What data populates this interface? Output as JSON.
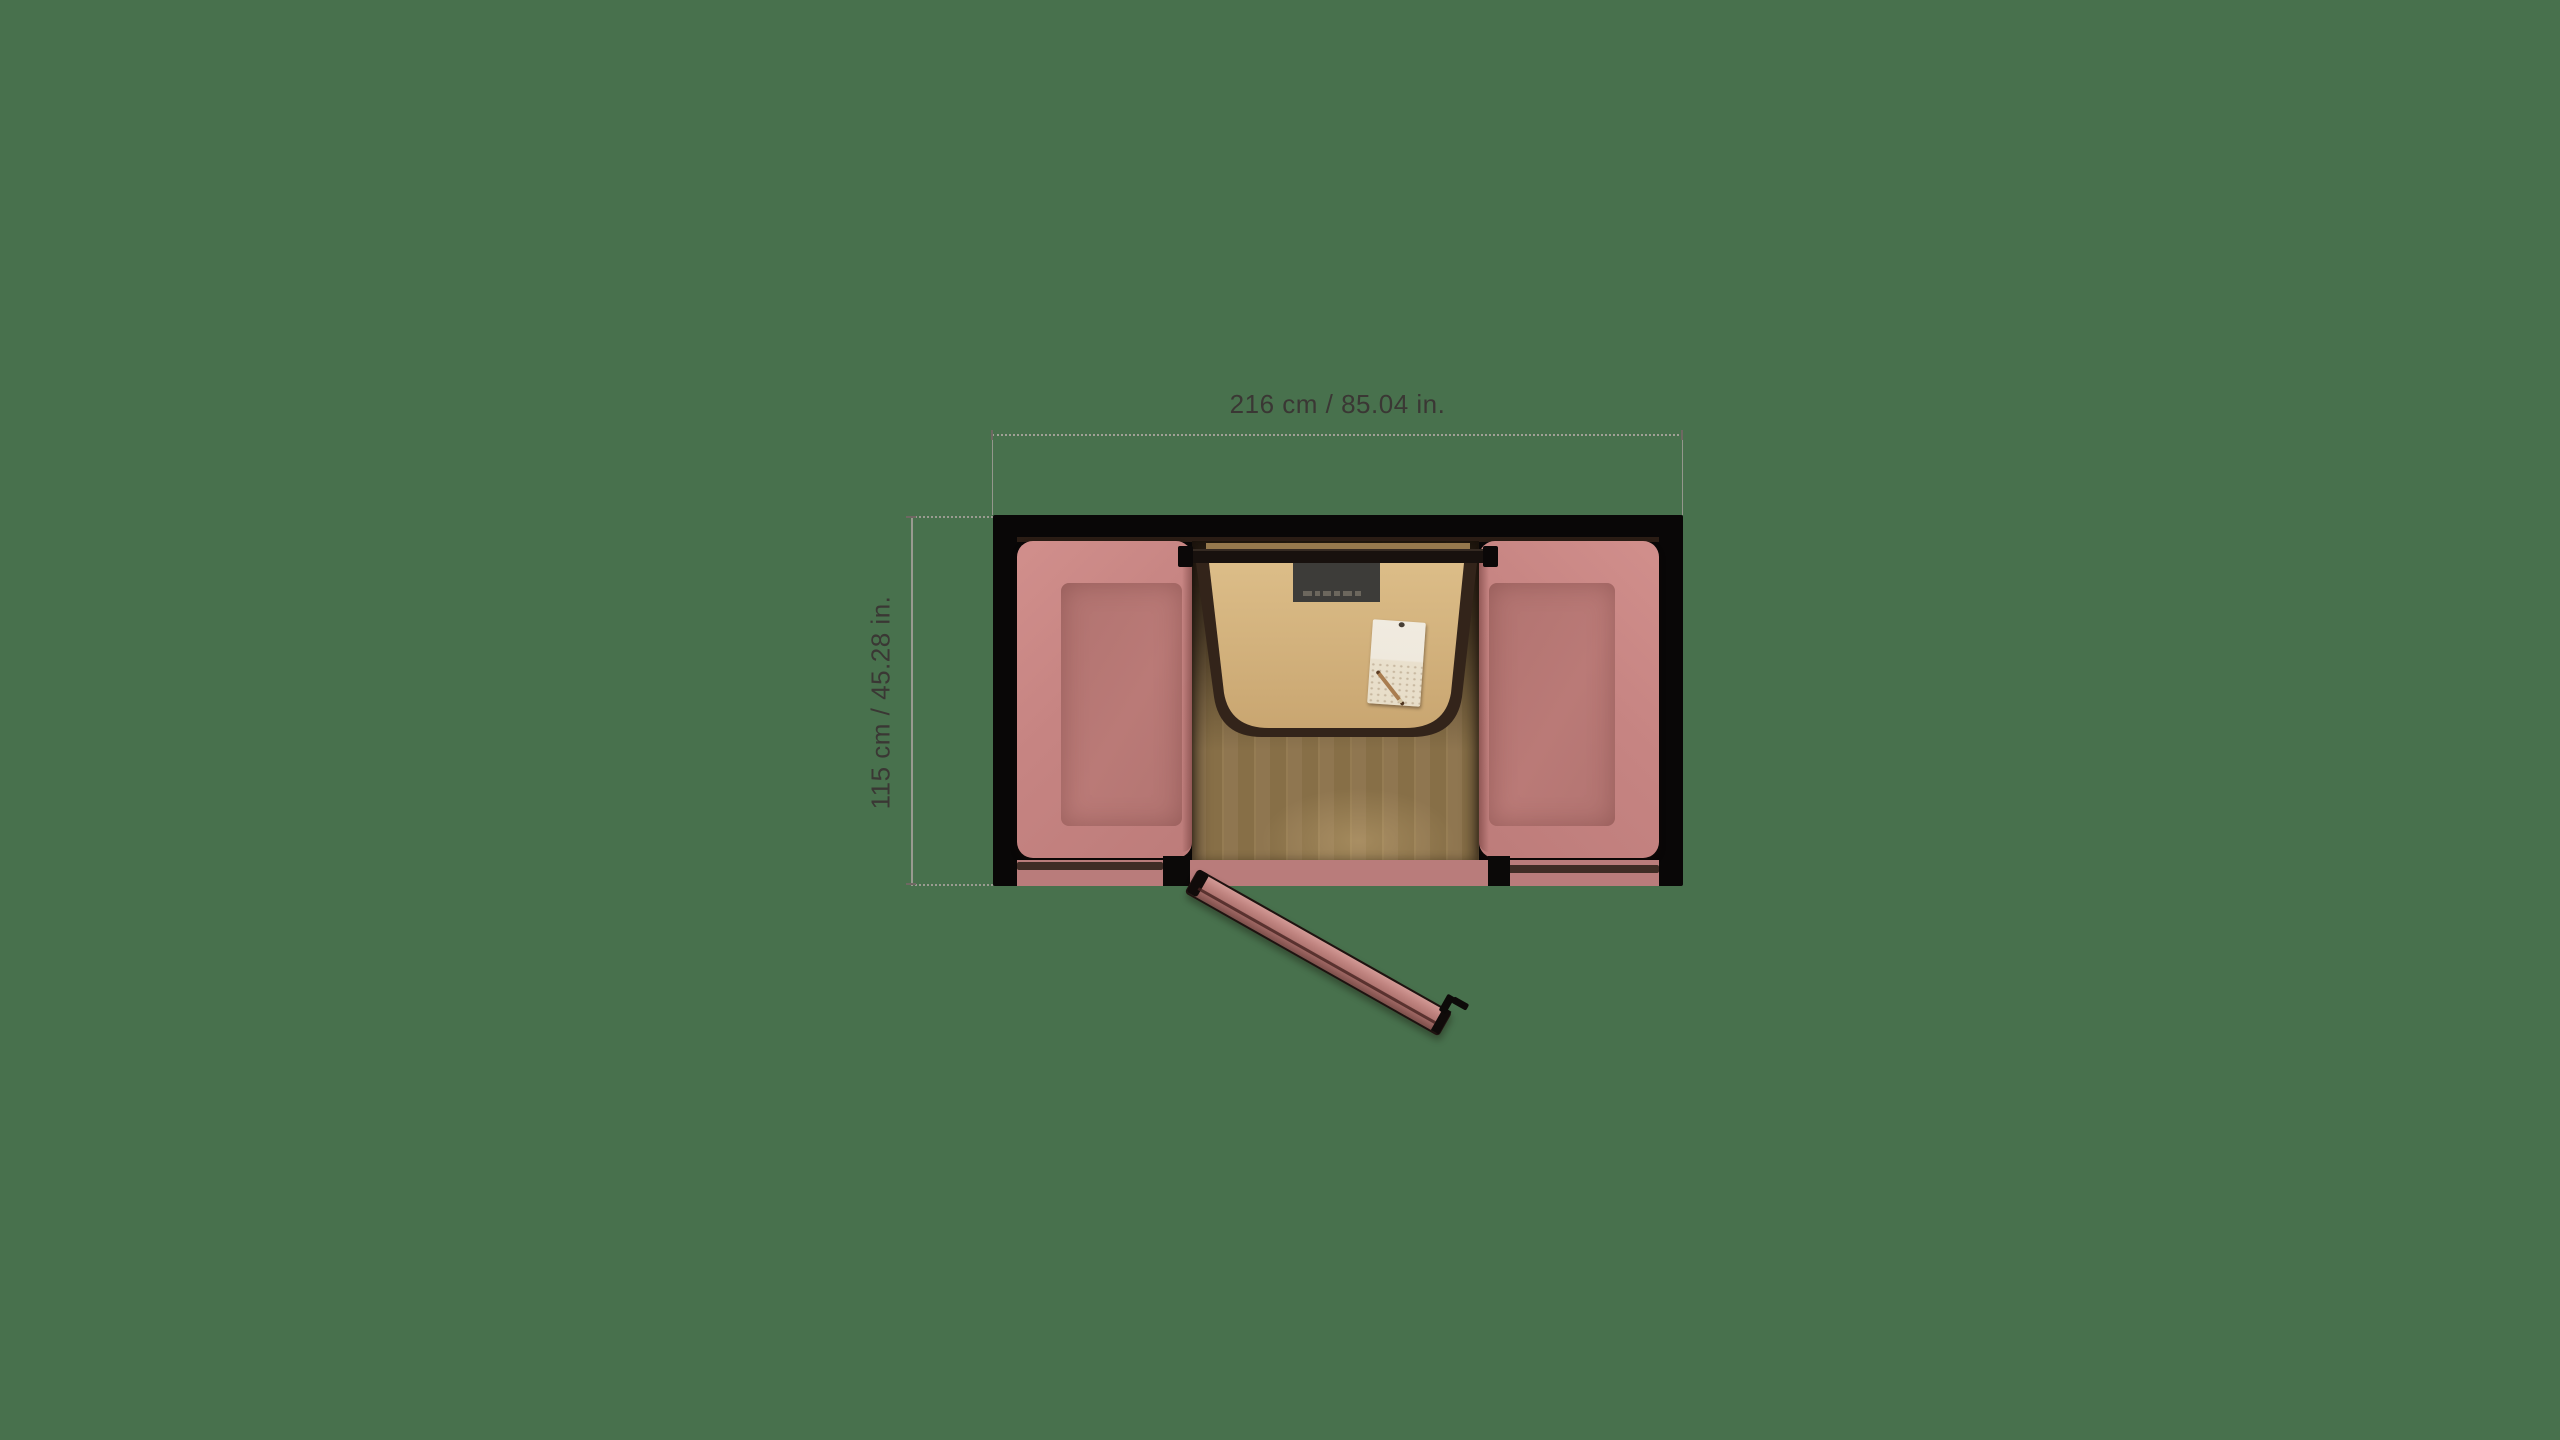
{
  "scene": {
    "view": "top-down floor plan of meeting pod",
    "background_color": "#48714d"
  },
  "annotations": {
    "width_dimension": {
      "label": "216 cm / 85.04 in."
    },
    "height_dimension": {
      "label": "115 cm / 45.28 in."
    },
    "line_color": "#a8a19c",
    "text_color": "#3a3734"
  },
  "palette": {
    "wall_black": "#090707",
    "sofa_edge_pink": "#d18f8c",
    "sofa_seat_pink": "#b47673",
    "bottom_panel_pink": "#b97c7b",
    "door_pink": "#b5807c",
    "table_wood": "#d3b27e",
    "table_side_shadow": "#33241a",
    "floor_wood": "#8c734d",
    "wall_rail_dark": "#18110e",
    "monitor_dark": "#3d3c39",
    "paper_white": "#efe9dd",
    "pencil_brown": "#a97d50"
  }
}
